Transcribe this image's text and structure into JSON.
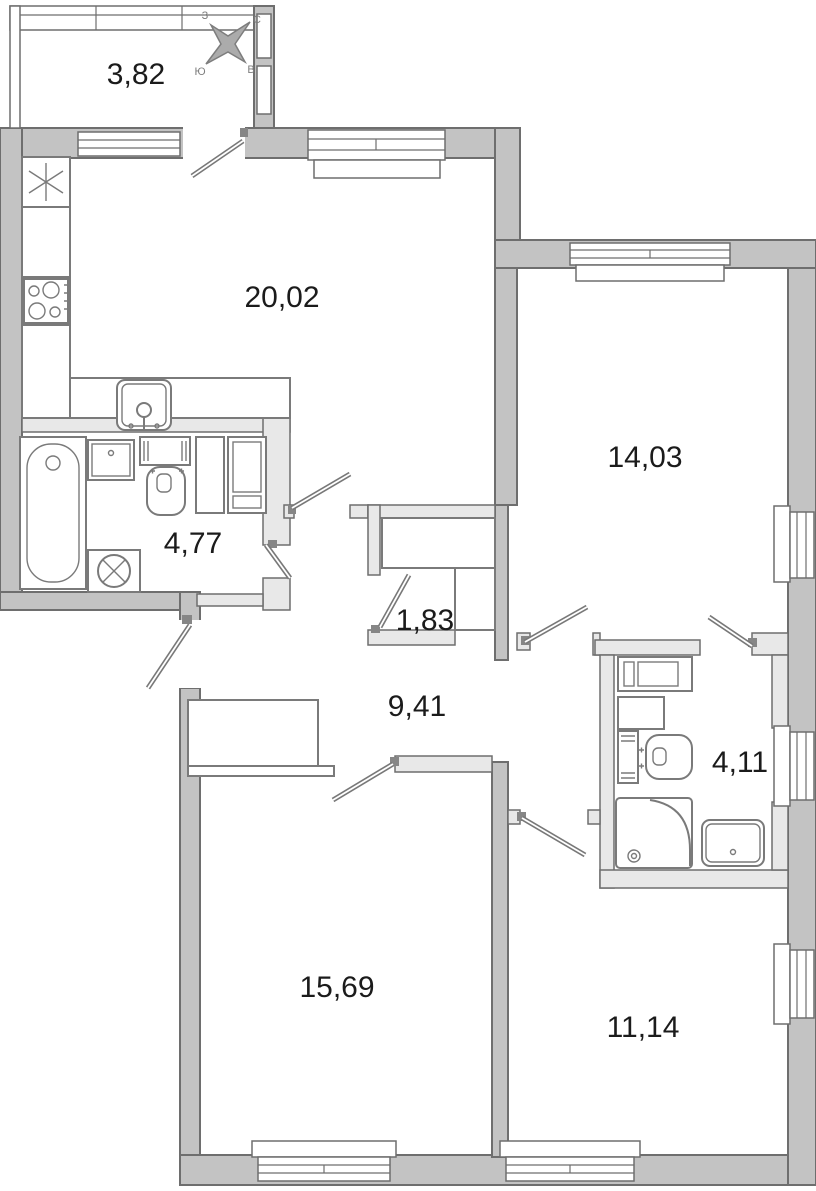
{
  "rooms": {
    "balcony": {
      "area": "3,82"
    },
    "kitchen_living": {
      "area": "20,02"
    },
    "bedroom_main": {
      "area": "14,03"
    },
    "bathroom_main": {
      "area": "4,77"
    },
    "closet": {
      "area": "1,83"
    },
    "hallway": {
      "area": "9,41"
    },
    "bathroom_ensuite": {
      "area": "4,11"
    },
    "bedroom_left": {
      "area": "15,69"
    },
    "bedroom_right": {
      "area": "11,14"
    }
  },
  "compass": {
    "north": "С",
    "east": "В",
    "south": "Ю",
    "west": "З"
  },
  "colors": {
    "wall": "#c3c3c3",
    "wall-stroke": "#6e6e6e",
    "partition": "#e8e8e8",
    "furniture": "#7a7a7a",
    "label": "#1b1b1b",
    "leaf": "#787878"
  }
}
